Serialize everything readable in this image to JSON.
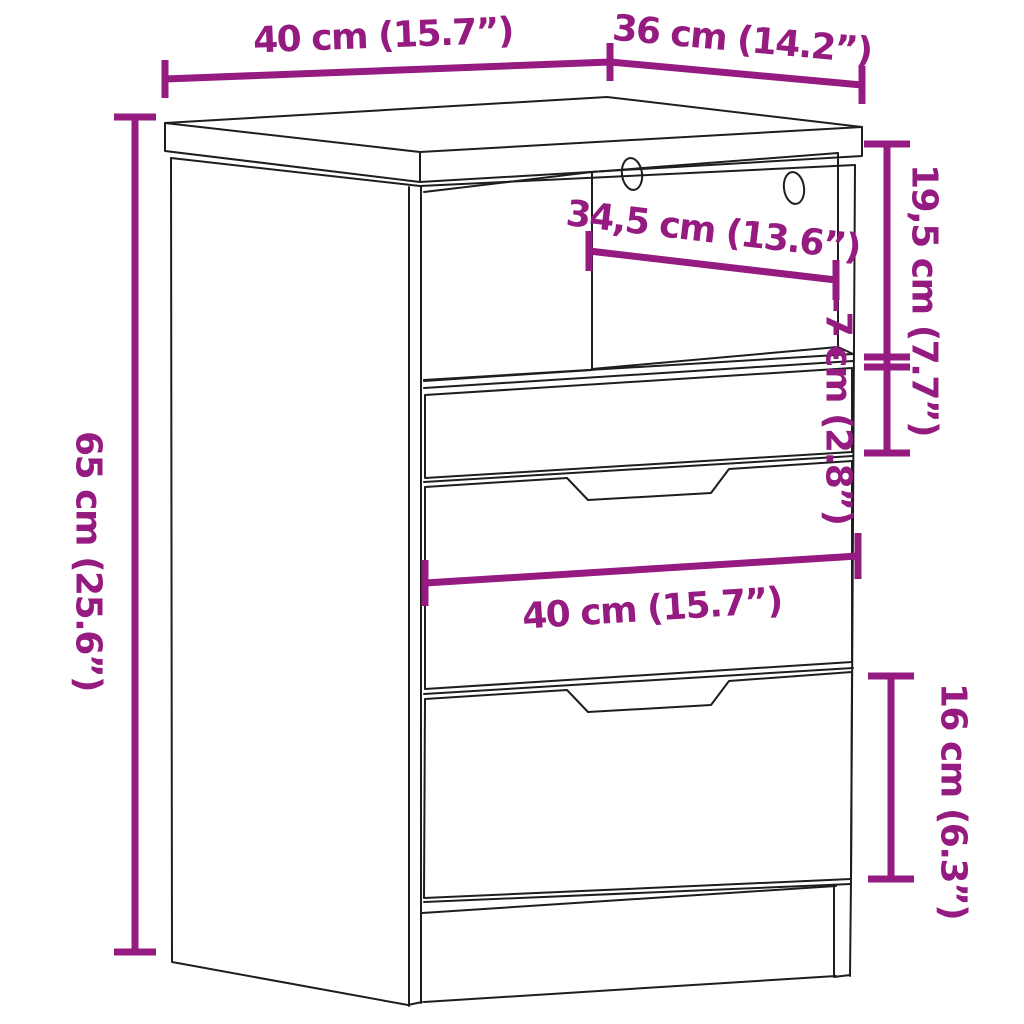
{
  "diagram": {
    "type": "furniture-dimension-line-drawing",
    "subject": "bedside cabinet with open compartment and three drawers",
    "background_color": "#ffffff",
    "outline_color": "#1e1e1e",
    "accent_color": "#951b81"
  },
  "dimensions": {
    "width_top": {
      "text": "40 cm (15.7”)"
    },
    "depth_top": {
      "text": "36 cm (14.2”)"
    },
    "inner_width": {
      "text": "34,5 cm (13.6”)"
    },
    "compartment_height": {
      "text": "19,5 cm (7.7”)"
    },
    "top_drawer_height": {
      "text": "7 cm (2.8”)"
    },
    "total_height": {
      "text": "65 cm (25.6”)"
    },
    "width_mid": {
      "text": "40 cm (15.7”)"
    },
    "bottom_drawer_height": {
      "text": "16 cm (6.3”)"
    }
  }
}
